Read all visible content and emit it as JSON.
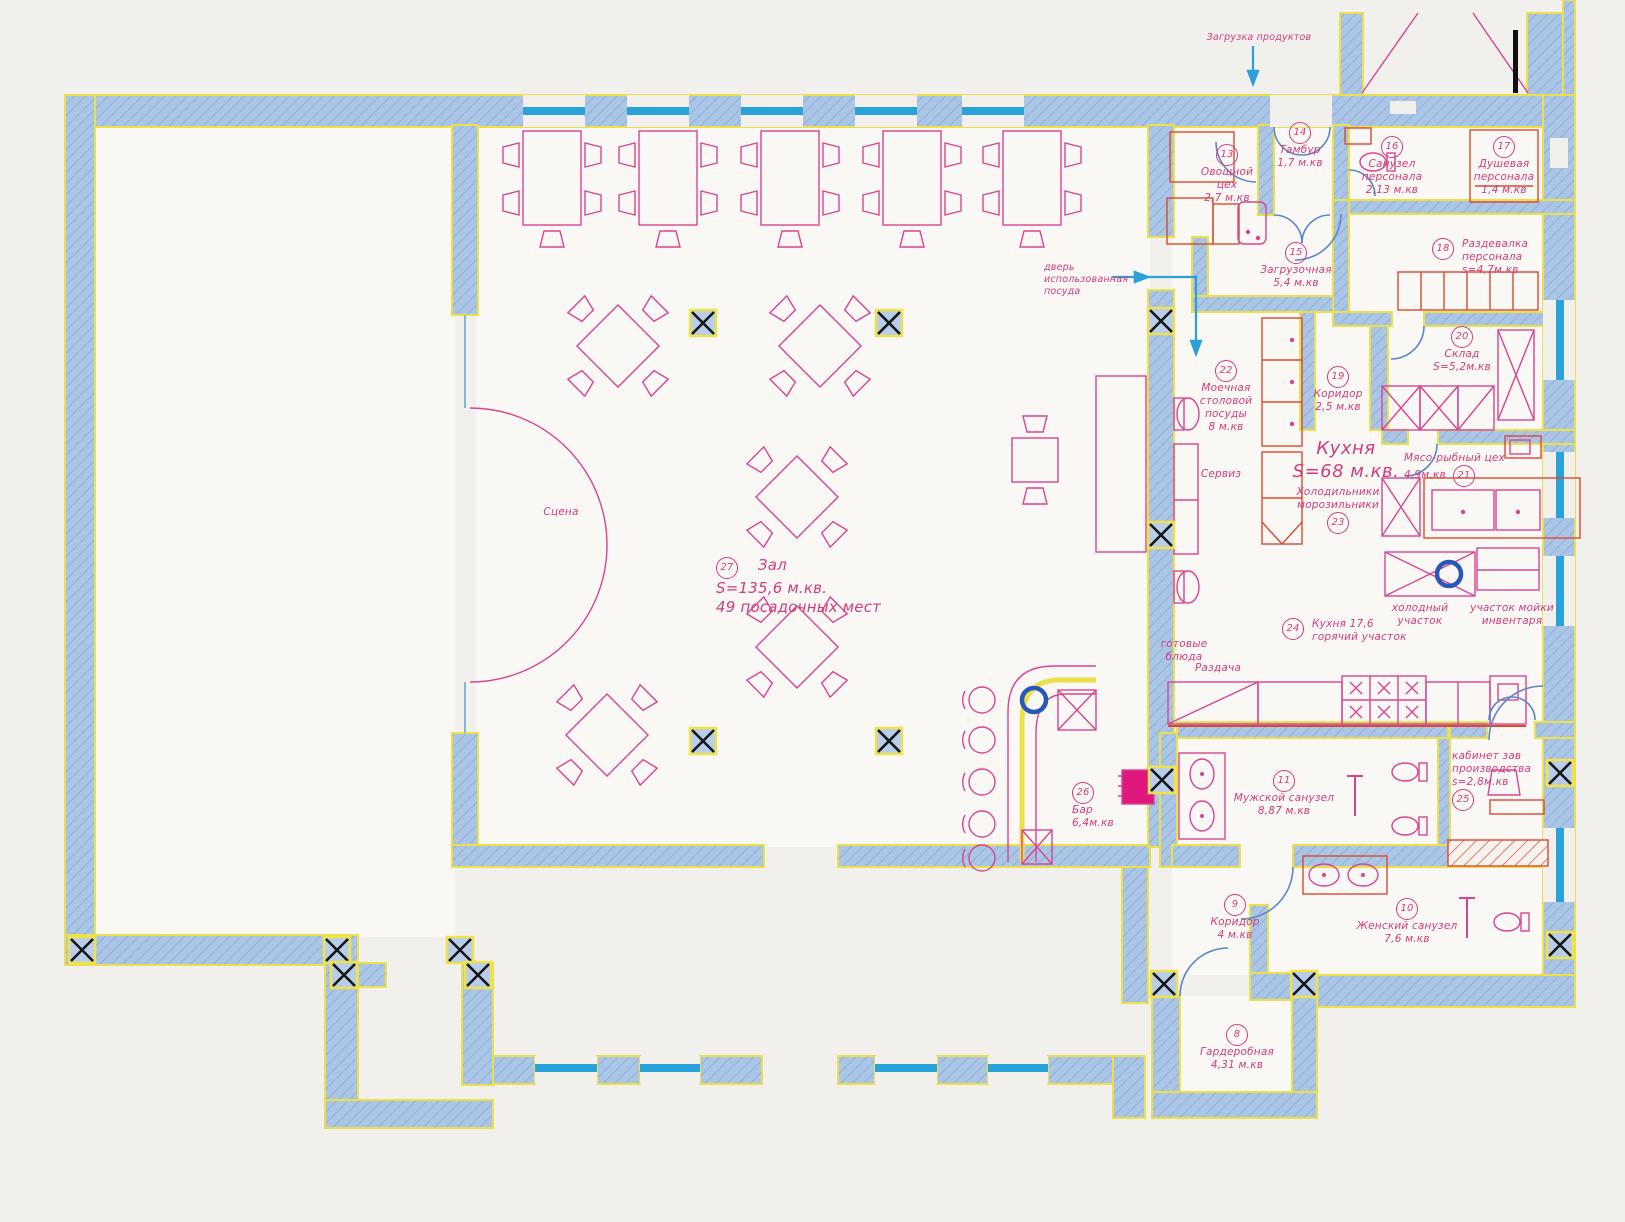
{
  "colors": {
    "wall_fill": "#abc5e7",
    "wall_edge": "#ece04a",
    "furniture_pink": "#d8458f",
    "text_pink": "#d33d7b",
    "equipment_red": "#d84b30",
    "window_cyan": "#29a2da",
    "door_blue": "#5b86c8",
    "column_black": "#151515",
    "sink_blue": "#2857b8"
  },
  "annotations": {
    "loading": "Загрузка продуктов",
    "dishes_line1": "дверь",
    "dishes_line2": "использованная",
    "dishes_line3": "посуда"
  },
  "kitchen_title": {
    "name": "Кухня",
    "area": "S=68 м.кв."
  },
  "rooms": {
    "r8": {
      "num": "8",
      "l1": "Гардеробная",
      "l2": "4,31 м.кв"
    },
    "r9": {
      "num": "9",
      "l1": "Коридор",
      "l2": "4 м.кв"
    },
    "r10": {
      "num": "10",
      "l1": "Женский санузел",
      "l2": "7,6 м.кв"
    },
    "r11": {
      "num": "11",
      "l1": "Мужской санузел",
      "l2": "8,87 м.кв"
    },
    "r13": {
      "num": "13",
      "l1": "Овощной",
      "l2": "цех",
      "l3": "2,7 м.кв"
    },
    "r14": {
      "num": "14",
      "l1": "Тамбур",
      "l2": "1,7 м.кв"
    },
    "r15": {
      "num": "15",
      "l1": "Загрузочная",
      "l2": "5,4 м.кв"
    },
    "r16": {
      "num": "16",
      "l1": "Санузел",
      "l2": "персонала",
      "l3": "2,13 м.кв"
    },
    "r17": {
      "num": "17",
      "l1": "Душевая",
      "l2": "персонала",
      "l3": "1,4 м.кв"
    },
    "r18": {
      "num": "18",
      "l1": "Раздевалка",
      "l2": "персонала",
      "l3": "s=4,7м.кв"
    },
    "r19": {
      "num": "19",
      "l1": "Коридор",
      "l2": "2,5 м.кв"
    },
    "r20": {
      "num": "20",
      "l1": "Склад",
      "l2": "S=5,2м.кв"
    },
    "r21": {
      "num": "21",
      "l1": "Мясо-рыбный цех",
      "l2": "4,9м.кв"
    },
    "r22": {
      "num": "22",
      "l1": "Моечная",
      "l2": "столовой",
      "l3": "посуды",
      "l4": "8 м.кв"
    },
    "r23": {
      "num": "23",
      "l1": "Холодильники",
      "l2": "морозильники"
    },
    "r24": {
      "num": "24",
      "l1": "Кухня 17,6",
      "l2": "горячий участок"
    },
    "r25": {
      "num": "25",
      "l1": "кабинет зав",
      "l2": "производства",
      "l3": "s=2,8м.кв"
    },
    "r26": {
      "num": "26",
      "l1": "Бар",
      "l2": "6,4м.кв"
    },
    "r27": {
      "num": "27",
      "l1": "Зал",
      "l2": "S=135,6 м.кв.",
      "l3": "49 посадочных мест"
    }
  },
  "zones": {
    "stage": "Сцена",
    "service": "Сервиз",
    "ready": "готовые блюда",
    "serve": "Раздача",
    "cold1": "холодный",
    "cold2": "участок",
    "wash1": "участок мойки",
    "wash2": "инвентаря"
  }
}
